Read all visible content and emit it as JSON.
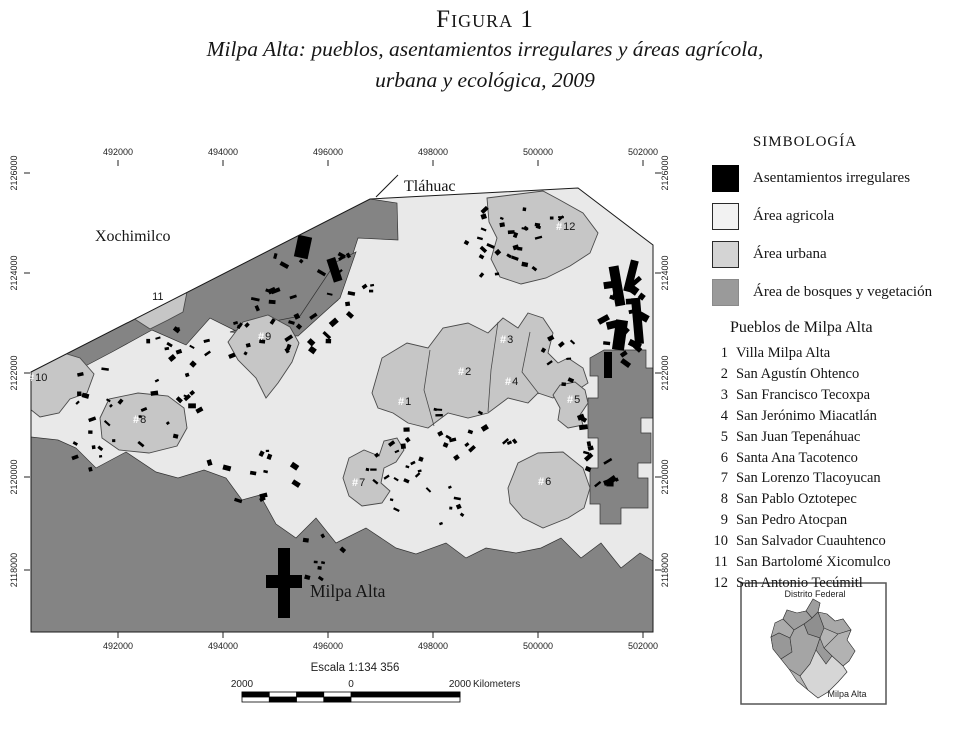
{
  "figure": {
    "label": "Figura 1",
    "subtitle_line1": "Milpa Alta: pueblos, asentamientos irregulares y áreas agrícola,",
    "subtitle_line2": "urbana y ecológica, 2009"
  },
  "legend": {
    "title": "SIMBOLOGÍA",
    "items": [
      {
        "label": "Asentamientos irregulares",
        "color": "#000000",
        "border": "#000000"
      },
      {
        "label": "Área agricola",
        "color": "#f2f2f2",
        "border": "#2a2a2a"
      },
      {
        "label": "Área urbana",
        "color": "#d4d4d4",
        "border": "#2a2a2a"
      },
      {
        "label": "Área de bosques y vegetación",
        "color": "#9a9a9a",
        "border": "#8a8a8a"
      }
    ]
  },
  "pueblos": {
    "title": "Pueblos de Milpa Alta",
    "items": [
      {
        "num": "1",
        "name": "Villa Milpa Alta"
      },
      {
        "num": "2",
        "name": "San Agustín Ohtenco"
      },
      {
        "num": "3",
        "name": "San Francisco Tecoxpa"
      },
      {
        "num": "4",
        "name": "San Jerónimo Miacatlán"
      },
      {
        "num": "5",
        "name": "San Juan Tepenáhuac"
      },
      {
        "num": "6",
        "name": "Santa Ana Tacotenco"
      },
      {
        "num": "7",
        "name": "San Lorenzo Tlacoyucan"
      },
      {
        "num": "8",
        "name": "San Pablo Oztotepec"
      },
      {
        "num": "9",
        "name": "San Pedro Atocpan"
      },
      {
        "num": "10",
        "name": "San Salvador Cuauhtenco"
      },
      {
        "num": "11",
        "name": "San Bartolomé Xicomulco"
      },
      {
        "num": "12",
        "name": "San Antonio Tecúmitl"
      }
    ]
  },
  "map": {
    "colors": {
      "agricola": "#e9e9e9",
      "urbana": "#c6c6c6",
      "bosques": "#848484",
      "asentamientos": "#000000"
    },
    "region_labels": [
      {
        "text": "Xochimilco",
        "x": 95,
        "y": 241,
        "big": false
      },
      {
        "text": "Tláhuac",
        "x": 404,
        "y": 191,
        "big": false
      },
      {
        "text": "Milpa Alta",
        "x": 310,
        "y": 597,
        "big": true
      }
    ],
    "marker_prefix": "#",
    "markers": [
      {
        "num": "1",
        "x": 398,
        "y": 405
      },
      {
        "num": "2",
        "x": 458,
        "y": 375
      },
      {
        "num": "3",
        "x": 500,
        "y": 343
      },
      {
        "num": "4",
        "x": 505,
        "y": 385
      },
      {
        "num": "5",
        "x": 567,
        "y": 403
      },
      {
        "num": "6",
        "x": 538,
        "y": 485
      },
      {
        "num": "7",
        "x": 352,
        "y": 486
      },
      {
        "num": "8",
        "x": 133,
        "y": 423
      },
      {
        "num": "9",
        "x": 258,
        "y": 340
      },
      {
        "num": "10",
        "x": 28,
        "y": 381
      },
      {
        "num": "11",
        "x": 145,
        "y": 300
      },
      {
        "num": "12",
        "x": 556,
        "y": 230
      }
    ],
    "axis": {
      "x_ticks": [
        {
          "label": "492000",
          "x": 118
        },
        {
          "label": "494000",
          "x": 223
        },
        {
          "label": "496000",
          "x": 328
        },
        {
          "label": "498000",
          "x": 433
        },
        {
          "label": "500000",
          "x": 538
        },
        {
          "label": "502000",
          "x": 643
        }
      ],
      "y_ticks": [
        {
          "label": "2126000",
          "y": 173
        },
        {
          "label": "2124000",
          "y": 273
        },
        {
          "label": "2122000",
          "y": 373
        },
        {
          "label": "2120000",
          "y": 477
        },
        {
          "label": "2118000",
          "y": 570
        }
      ]
    },
    "settlement_clusters": [
      {
        "cx": 300,
        "cy": 300,
        "rx": 45,
        "ry": 60,
        "n": 26,
        "smin": 3,
        "smax": 9
      },
      {
        "cx": 350,
        "cy": 290,
        "rx": 25,
        "ry": 45,
        "n": 10,
        "smin": 3,
        "smax": 8
      },
      {
        "cx": 500,
        "cy": 250,
        "rx": 40,
        "ry": 45,
        "n": 22,
        "smin": 3,
        "smax": 8
      },
      {
        "cx": 545,
        "cy": 222,
        "rx": 25,
        "ry": 25,
        "n": 8,
        "smin": 3,
        "smax": 7
      },
      {
        "cx": 622,
        "cy": 310,
        "rx": 22,
        "ry": 55,
        "n": 18,
        "smin": 5,
        "smax": 13
      },
      {
        "cx": 595,
        "cy": 455,
        "rx": 25,
        "ry": 55,
        "n": 14,
        "smin": 3,
        "smax": 9
      },
      {
        "cx": 460,
        "cy": 440,
        "rx": 60,
        "ry": 35,
        "n": 20,
        "smin": 3,
        "smax": 8
      },
      {
        "cx": 395,
        "cy": 470,
        "rx": 35,
        "ry": 30,
        "n": 12,
        "smin": 3,
        "smax": 7
      },
      {
        "cx": 150,
        "cy": 390,
        "rx": 80,
        "ry": 55,
        "n": 30,
        "smin": 3,
        "smax": 8
      },
      {
        "cx": 215,
        "cy": 345,
        "rx": 55,
        "ry": 25,
        "n": 14,
        "smin": 3,
        "smax": 7
      },
      {
        "cx": 250,
        "cy": 475,
        "rx": 50,
        "ry": 30,
        "n": 12,
        "smin": 3,
        "smax": 9
      },
      {
        "cx": 320,
        "cy": 560,
        "rx": 30,
        "ry": 25,
        "n": 8,
        "smin": 3,
        "smax": 7
      },
      {
        "cx": 430,
        "cy": 500,
        "rx": 40,
        "ry": 25,
        "n": 10,
        "smin": 3,
        "smax": 7
      },
      {
        "cx": 560,
        "cy": 360,
        "rx": 25,
        "ry": 25,
        "n": 8,
        "smin": 3,
        "smax": 7
      },
      {
        "cx": 90,
        "cy": 440,
        "rx": 30,
        "ry": 30,
        "n": 8,
        "smin": 3,
        "smax": 7
      }
    ]
  },
  "scalebar": {
    "title": "Escala 1:134 356",
    "left": "2000",
    "zero": "0",
    "right": "2000",
    "unit": "Kilometers"
  },
  "inset": {
    "title": "Distrito Federal",
    "label": "Milpa Alta"
  }
}
